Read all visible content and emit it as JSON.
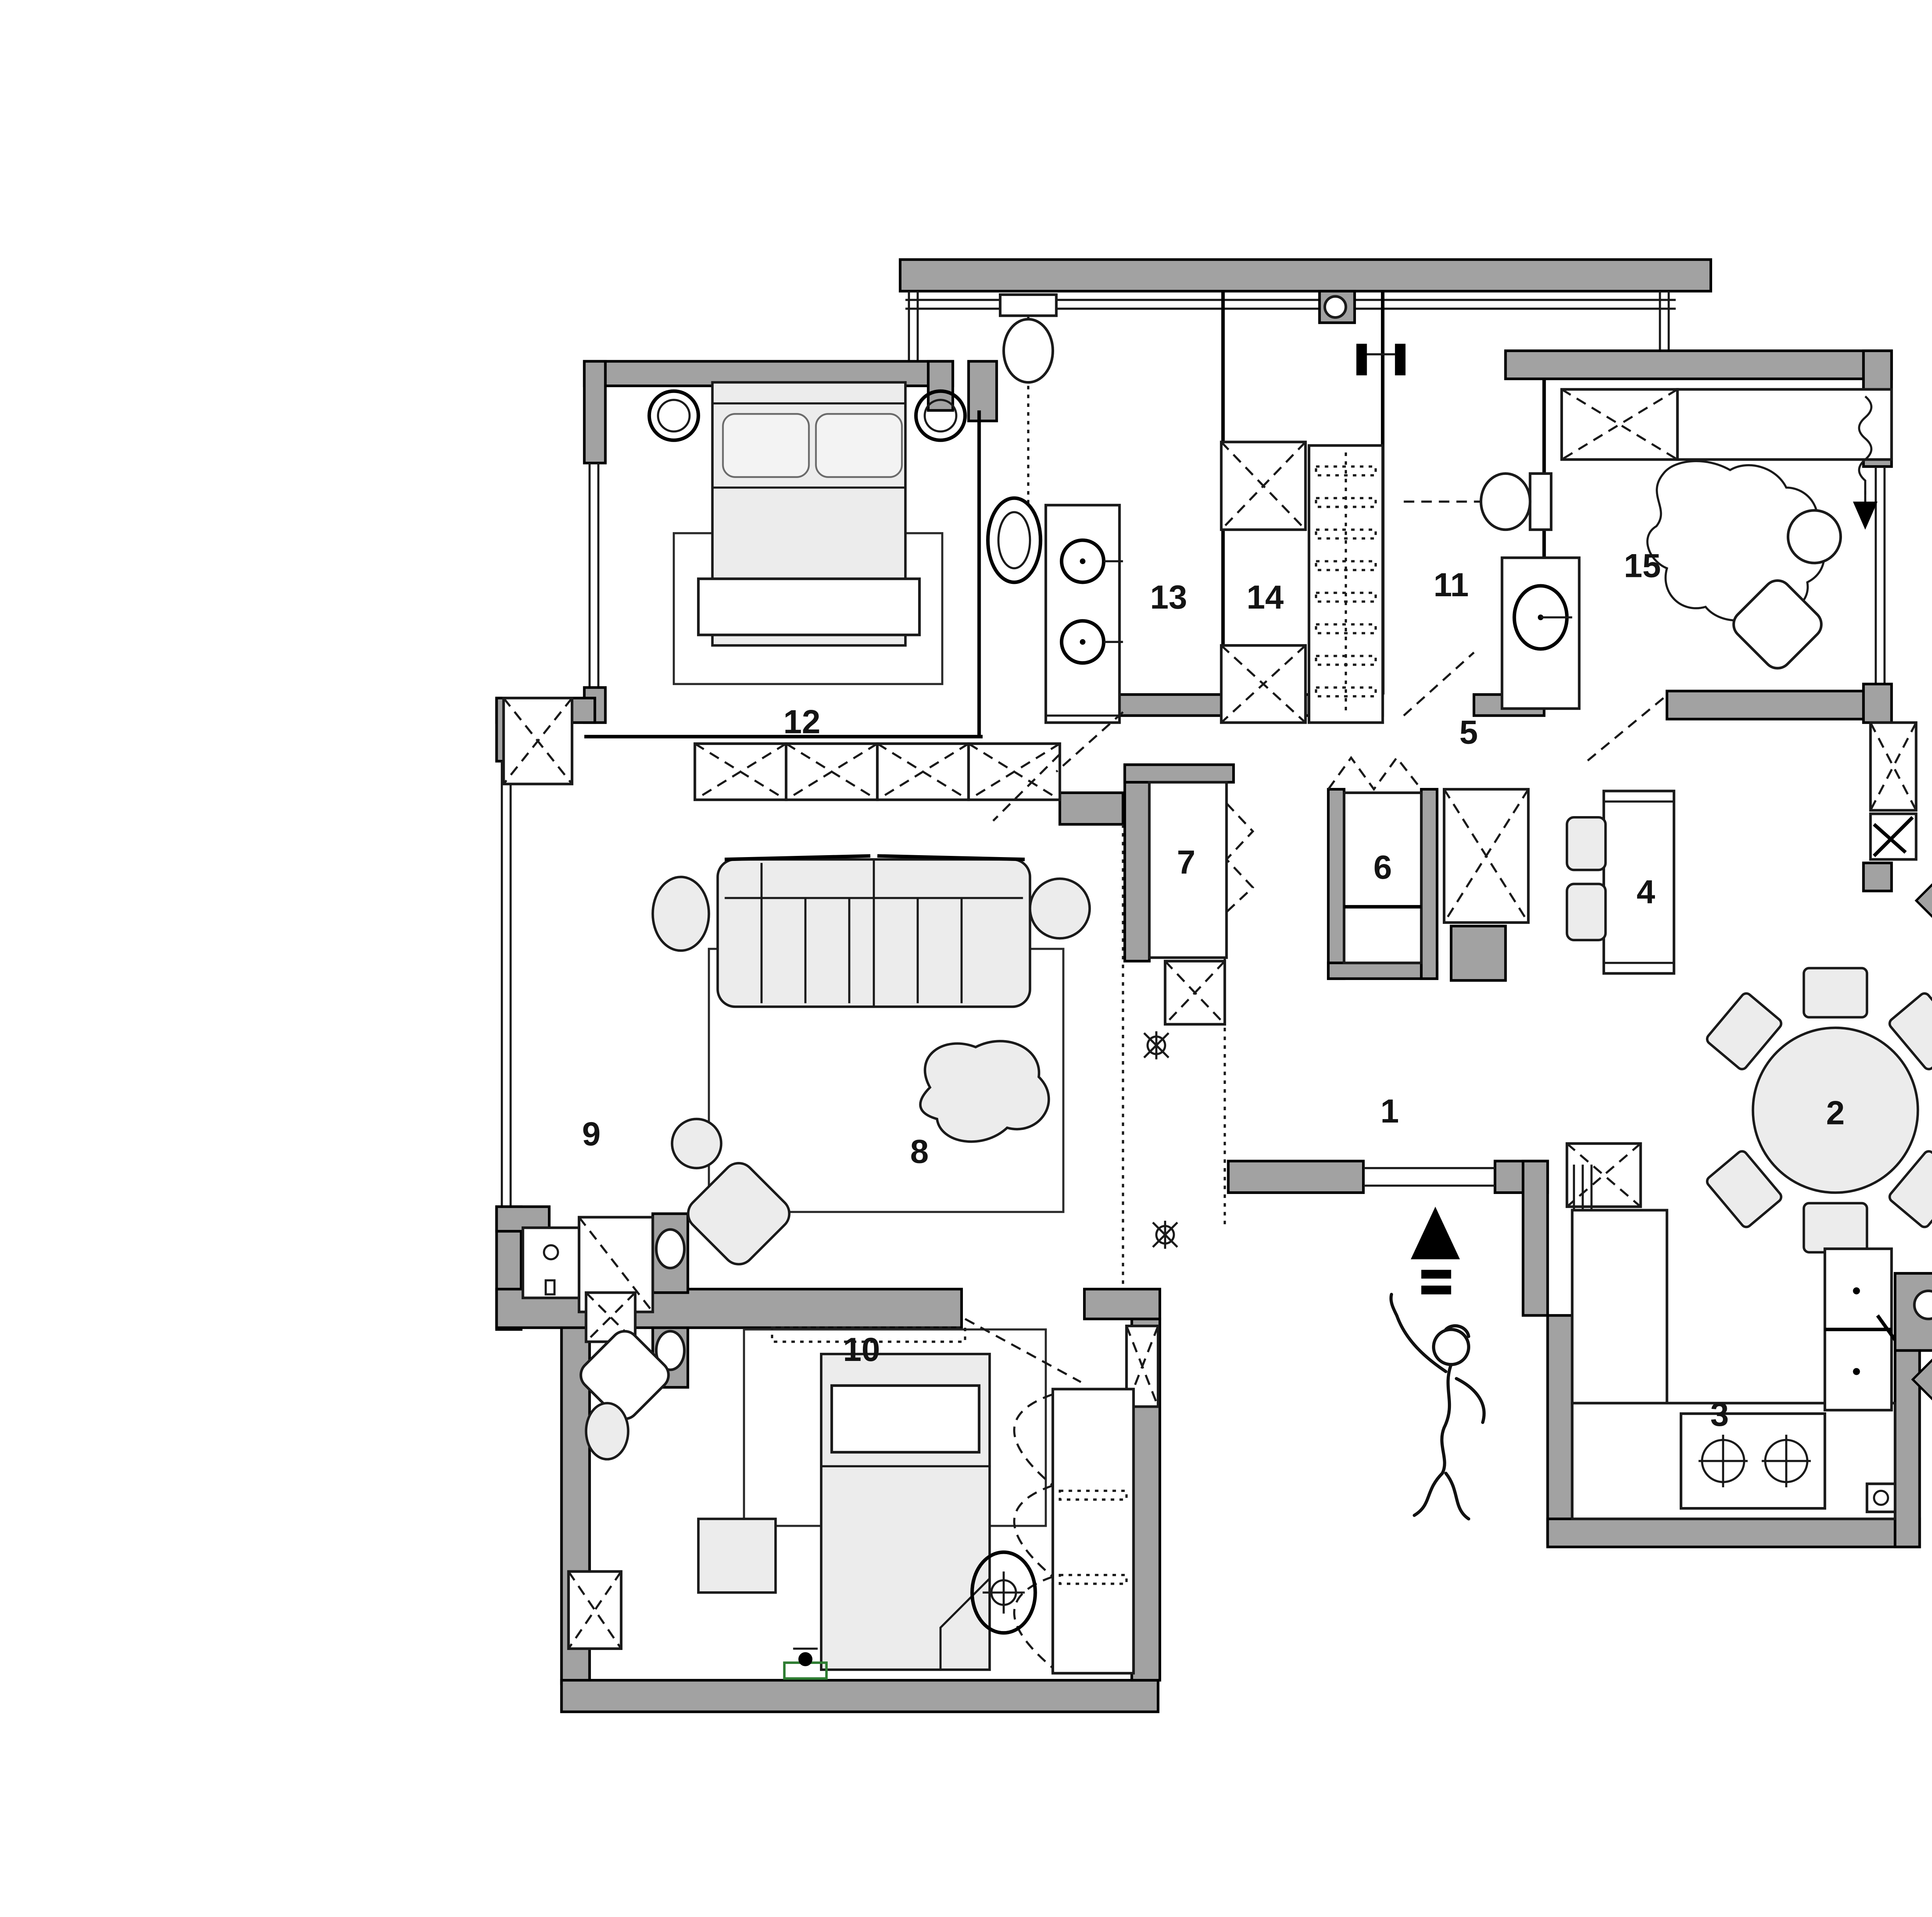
{
  "colors": {
    "wall": "#a2a2a2",
    "furn": "#ececec",
    "ink": "#111111",
    "accent": "#2e7d32"
  },
  "legend": {
    "items": [
      {
        "num": "1",
        "zh": "門廳",
        "en": "Lobby"
      },
      {
        "num": "2",
        "zh": "就餐區",
        "en": "Dining room"
      },
      {
        "num": "3",
        "zh": "廚房",
        "en": "kitchen"
      },
      {
        "num": "4",
        "zh": "西廚",
        "en": "Western Kitchen"
      },
      {
        "num": "5",
        "zh": "通道",
        "en": "Passageway"
      },
      {
        "num": "6",
        "zh": "儲物區",
        "en": "Storage area"
      },
      {
        "num": "7",
        "zh": "貓舍",
        "en": "Cat House"
      },
      {
        "num": "8",
        "zh": "會客區",
        "en": "Living room"
      },
      {
        "num": "9",
        "zh": "洗衣區",
        "en": "Laundry area"
      },
      {
        "num": "10",
        "zh": "女孩房",
        "en": "Girls' room"
      },
      {
        "num": "11",
        "zh": "衛生間",
        "en": "Toilet"
      },
      {
        "num": "12",
        "zh": "主臥室",
        "en": "Master bedroom"
      },
      {
        "num": "13",
        "zh": "衛生間",
        "en": "Toilet"
      },
      {
        "num": "14",
        "zh": "衣帽間",
        "en": "Cloakroom"
      },
      {
        "num": "15",
        "zh": "多功能房",
        "en": "Multifunction room"
      }
    ]
  }
}
